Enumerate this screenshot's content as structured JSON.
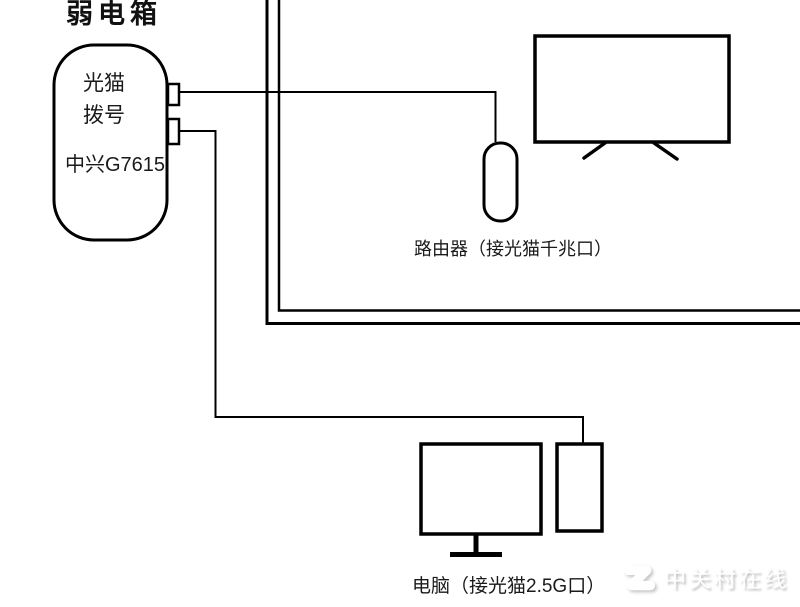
{
  "diagram": {
    "title": "弱电箱",
    "modem": {
      "label_line1": "光猫",
      "label_line2": "拨号",
      "model": "中兴G7615"
    },
    "router": {
      "label": "路由器（接光猫千兆口）"
    },
    "computer": {
      "label": "电脑（接光猫2.5G口）"
    },
    "watermark": {
      "brand": "中关村在线",
      "logo": "zol-z-logo"
    }
  },
  "colors": {
    "ink": "#000000",
    "text": "#1a1a1a",
    "background": "#ffffff",
    "watermark_fill": "#ffffff",
    "watermark_shadow": "#bfbfbf"
  }
}
